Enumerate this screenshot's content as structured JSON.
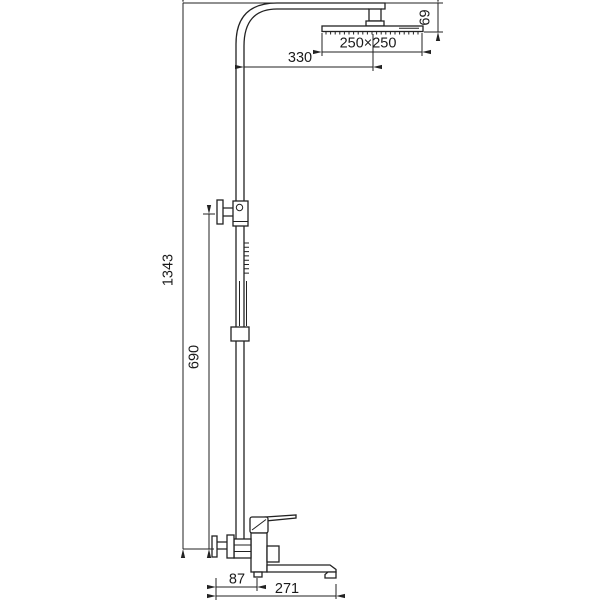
{
  "drawing": {
    "background": "#ffffff",
    "line_color": "#222222",
    "text_color": "#1a1a1a"
  },
  "dimensions": {
    "arm_reach": "330",
    "head_size": "250×250",
    "head_drop": "69",
    "total_height": "1343",
    "bracket_height": "690",
    "wall_to_outlet": "87",
    "spout_reach": "271"
  }
}
